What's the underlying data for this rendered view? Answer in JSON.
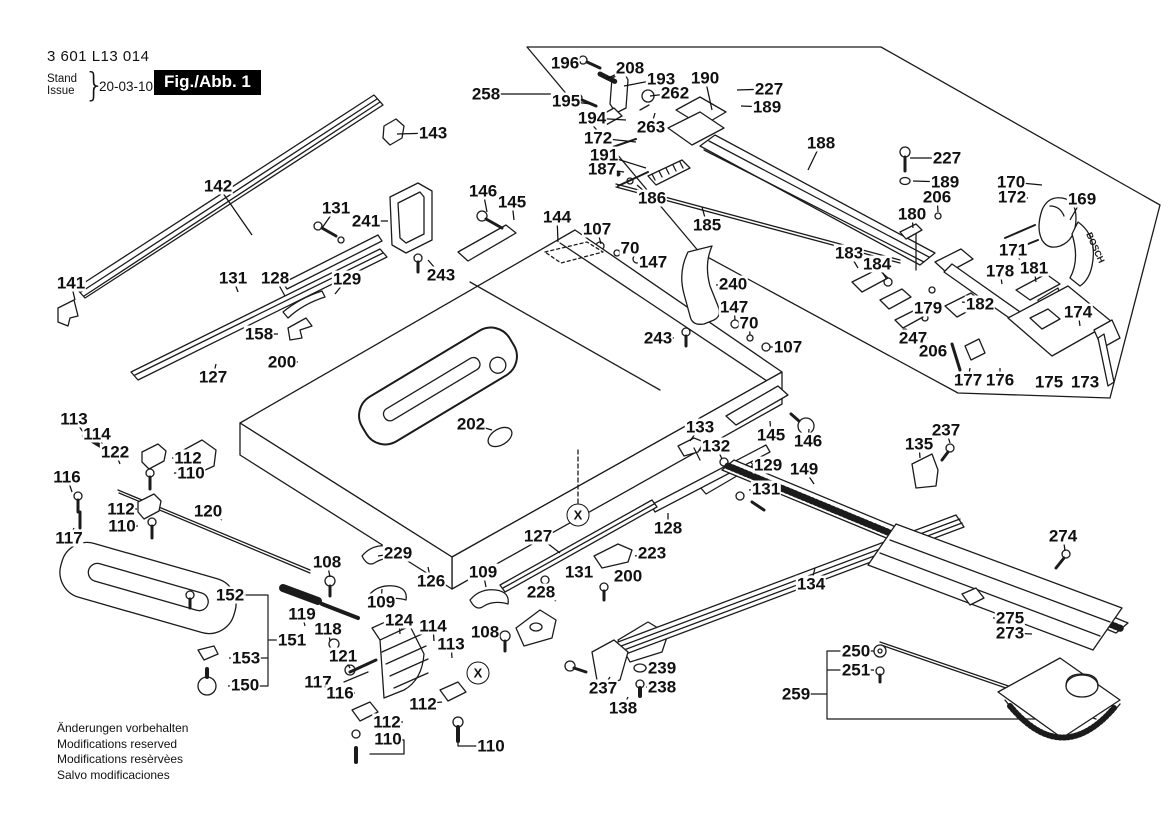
{
  "header": {
    "part_number": "3 601 L13 014",
    "stand_label": "Stand",
    "issue_label": "Issue",
    "brace": "}",
    "date": "20-03-10",
    "figure_label": "Fig./Abb. 1"
  },
  "footer": {
    "line1": "Änderungen vorbehalten",
    "line2": "Modifications reserved",
    "line3": "Modifications resèrvèes",
    "line4": "Salvo modificaciones"
  },
  "badge_text": "BOSCH",
  "symbols": [
    {
      "t": "X",
      "x": 578,
      "y": 515
    },
    {
      "t": "X",
      "x": 478,
      "y": 673
    }
  ],
  "labels": [
    {
      "t": "143",
      "x": 433,
      "y": 133,
      "l": [
        397,
        134
      ]
    },
    {
      "t": "142",
      "x": 218,
      "y": 186,
      "l": [
        252,
        235
      ]
    },
    {
      "t": "131",
      "x": 336,
      "y": 208,
      "l": [
        322,
        228
      ]
    },
    {
      "t": "241",
      "x": 366,
      "y": 221,
      "l": [
        388,
        221
      ]
    },
    {
      "t": "146",
      "x": 483,
      "y": 191,
      "l": [
        487,
        212
      ]
    },
    {
      "t": "145",
      "x": 512,
      "y": 202,
      "l": [
        514,
        220
      ]
    },
    {
      "t": "144",
      "x": 557,
      "y": 217,
      "l": [
        558,
        242
      ]
    },
    {
      "t": "107",
      "x": 597,
      "y": 229,
      "l": [
        601,
        244
      ]
    },
    {
      "t": "70",
      "x": 630,
      "y": 248,
      "l": [
        620,
        252
      ]
    },
    {
      "t": "147",
      "x": 653,
      "y": 262,
      "l": [
        641,
        261
      ]
    },
    {
      "t": "186",
      "x": 652,
      "y": 198,
      "l": [
        637,
        185
      ]
    },
    {
      "t": "243",
      "x": 441,
      "y": 275,
      "l": [
        428,
        260
      ]
    },
    {
      "t": "258",
      "x": 486,
      "y": 94,
      "l": [
        560,
        94
      ]
    },
    {
      "t": "196",
      "x": 565,
      "y": 63,
      "l": [
        581,
        62
      ]
    },
    {
      "t": "208",
      "x": 630,
      "y": 68,
      "l": [
        606,
        79
      ]
    },
    {
      "t": "193",
      "x": 661,
      "y": 79,
      "l": [
        624,
        86
      ]
    },
    {
      "t": "190",
      "x": 705,
      "y": 78,
      "l": [
        712,
        110
      ]
    },
    {
      "t": "227",
      "x": 769,
      "y": 89,
      "l": [
        737,
        90
      ]
    },
    {
      "t": "262",
      "x": 675,
      "y": 93,
      "l": [
        650,
        96
      ]
    },
    {
      "t": "189",
      "x": 767,
      "y": 107,
      "l": [
        741,
        106
      ]
    },
    {
      "t": "195",
      "x": 566,
      "y": 101,
      "l": [
        591,
        104
      ]
    },
    {
      "t": "194",
      "x": 592,
      "y": 118,
      "l": [
        626,
        120
      ]
    },
    {
      "t": "263",
      "x": 651,
      "y": 127,
      "l": [
        655,
        113
      ]
    },
    {
      "t": "172",
      "x": 598,
      "y": 138,
      "l": [
        636,
        142
      ]
    },
    {
      "t": "191",
      "x": 604,
      "y": 155,
      "l": [
        646,
        168
      ]
    },
    {
      "t": "187",
      "x": 602,
      "y": 169,
      "l": [
        624,
        172
      ]
    },
    {
      "t": "185",
      "x": 707,
      "y": 225,
      "l": [
        702,
        207
      ]
    },
    {
      "t": "188",
      "x": 821,
      "y": 143,
      "l": [
        808,
        170
      ]
    },
    {
      "t": "227",
      "x": 947,
      "y": 158,
      "l": [
        910,
        158
      ]
    },
    {
      "t": "189",
      "x": 945,
      "y": 182,
      "l": [
        913,
        181
      ]
    },
    {
      "t": "206",
      "x": 937,
      "y": 197,
      "l": [
        938,
        212
      ]
    },
    {
      "t": "180",
      "x": 912,
      "y": 214,
      "l": [
        913,
        228
      ]
    },
    {
      "t": "170",
      "x": 1011,
      "y": 182,
      "l": [
        1042,
        185
      ]
    },
    {
      "t": "172",
      "x": 1012,
      "y": 197,
      "l": [
        1028,
        198
      ]
    },
    {
      "t": "169",
      "x": 1082,
      "y": 199,
      "l": [
        1070,
        220
      ]
    },
    {
      "t": "171",
      "x": 1013,
      "y": 250,
      "l": [
        1020,
        260
      ]
    },
    {
      "t": "183",
      "x": 849,
      "y": 253,
      "l": [
        858,
        268
      ]
    },
    {
      "t": "184",
      "x": 877,
      "y": 264,
      "l": [
        886,
        278
      ]
    },
    {
      "t": "178",
      "x": 1000,
      "y": 271,
      "l": [
        1002,
        284
      ]
    },
    {
      "t": "181",
      "x": 1034,
      "y": 268,
      "l": [
        1036,
        282
      ]
    },
    {
      "t": "179",
      "x": 928,
      "y": 308,
      "l": [
        940,
        316
      ]
    },
    {
      "t": "182",
      "x": 980,
      "y": 304,
      "l": [
        962,
        302
      ]
    },
    {
      "t": "174",
      "x": 1078,
      "y": 312,
      "l": [
        1080,
        326
      ]
    },
    {
      "t": "247",
      "x": 913,
      "y": 338,
      "l": [
        928,
        338
      ]
    },
    {
      "t": "206",
      "x": 933,
      "y": 351,
      "l": [
        946,
        351
      ]
    },
    {
      "t": "177",
      "x": 968,
      "y": 380,
      "l": [
        970,
        368
      ]
    },
    {
      "t": "176",
      "x": 1000,
      "y": 380,
      "l": [
        1000,
        368
      ]
    },
    {
      "t": "175",
      "x": 1049,
      "y": 382,
      "l": [
        1062,
        380
      ]
    },
    {
      "t": "173",
      "x": 1085,
      "y": 382,
      "l": [
        1098,
        380
      ]
    },
    {
      "t": "141",
      "x": 71,
      "y": 283,
      "l": [
        75,
        300
      ]
    },
    {
      "t": "131",
      "x": 233,
      "y": 278,
      "l": [
        238,
        292
      ]
    },
    {
      "t": "128",
      "x": 275,
      "y": 278,
      "l": [
        285,
        296
      ]
    },
    {
      "t": "129",
      "x": 347,
      "y": 279,
      "l": [
        335,
        294
      ]
    },
    {
      "t": "158",
      "x": 259,
      "y": 334,
      "l": [
        278,
        334
      ]
    },
    {
      "t": "200",
      "x": 282,
      "y": 362,
      "l": [
        298,
        362
      ]
    },
    {
      "t": "127",
      "x": 213,
      "y": 377,
      "l": [
        216,
        364
      ]
    },
    {
      "t": "113",
      "x": 74,
      "y": 419,
      "l": [
        90,
        442
      ]
    },
    {
      "t": "114",
      "x": 97,
      "y": 434,
      "l": [
        104,
        447
      ]
    },
    {
      "t": "122",
      "x": 115,
      "y": 452,
      "l": [
        120,
        464
      ]
    },
    {
      "t": "112",
      "x": 188,
      "y": 458,
      "l": [
        172,
        458
      ]
    },
    {
      "t": "110",
      "x": 191,
      "y": 473,
      "l": [
        174,
        473
      ]
    },
    {
      "t": "116",
      "x": 67,
      "y": 477,
      "l": [
        72,
        492
      ]
    },
    {
      "t": "112",
      "x": 121,
      "y": 509,
      "l": [
        137,
        509
      ]
    },
    {
      "t": "110",
      "x": 122,
      "y": 526,
      "l": [
        138,
        526
      ]
    },
    {
      "t": "117",
      "x": 69,
      "y": 538,
      "l": [
        74,
        528
      ]
    },
    {
      "t": "120",
      "x": 208,
      "y": 511,
      "l": [
        222,
        520
      ]
    },
    {
      "t": "202",
      "x": 471,
      "y": 424,
      "l": [
        492,
        430
      ]
    },
    {
      "t": "133",
      "x": 700,
      "y": 427,
      "l": [
        690,
        441
      ]
    },
    {
      "t": "132",
      "x": 716,
      "y": 446,
      "l": [
        722,
        459
      ]
    },
    {
      "t": "145",
      "x": 771,
      "y": 435,
      "l": [
        770,
        421
      ]
    },
    {
      "t": "146",
      "x": 808,
      "y": 441,
      "l": [
        809,
        429
      ]
    },
    {
      "t": "129",
      "x": 768,
      "y": 465,
      "l": [
        751,
        466
      ]
    },
    {
      "t": "149",
      "x": 804,
      "y": 469,
      "l": [
        814,
        484
      ]
    },
    {
      "t": "131",
      "x": 766,
      "y": 489,
      "l": [
        749,
        490
      ]
    },
    {
      "t": "128",
      "x": 668,
      "y": 528,
      "l": [
        668,
        513
      ]
    },
    {
      "t": "127",
      "x": 538,
      "y": 536,
      "l": [
        560,
        553
      ]
    },
    {
      "t": "108",
      "x": 327,
      "y": 562,
      "l": [
        330,
        577
      ]
    },
    {
      "t": "229",
      "x": 398,
      "y": 553,
      "l": [
        378,
        556
      ]
    },
    {
      "t": "126",
      "x": 431,
      "y": 581,
      "l": [
        428,
        567
      ]
    },
    {
      "t": "109",
      "x": 381,
      "y": 602,
      "l": [
        382,
        589
      ]
    },
    {
      "t": "109",
      "x": 483,
      "y": 572,
      "l": [
        486,
        587
      ]
    },
    {
      "t": "223",
      "x": 652,
      "y": 553,
      "l": [
        635,
        556
      ]
    },
    {
      "t": "131",
      "x": 579,
      "y": 572,
      "l": [
        564,
        574
      ]
    },
    {
      "t": "200",
      "x": 628,
      "y": 576,
      "l": [
        614,
        578
      ]
    },
    {
      "t": "228",
      "x": 541,
      "y": 592,
      "l": [
        556,
        601
      ]
    },
    {
      "t": "108",
      "x": 485,
      "y": 632,
      "l": [
        500,
        634
      ]
    },
    {
      "t": "152",
      "x": 230,
      "y": 595,
      "l": [
        245,
        595
      ]
    },
    {
      "t": "151",
      "x": 292,
      "y": 640,
      "l": [
        277,
        640
      ]
    },
    {
      "t": "153",
      "x": 246,
      "y": 658,
      "l": [
        229,
        658
      ]
    },
    {
      "t": "150",
      "x": 245,
      "y": 685,
      "l": [
        228,
        686
      ]
    },
    {
      "t": "119",
      "x": 302,
      "y": 614,
      "l": [
        305,
        626
      ]
    },
    {
      "t": "118",
      "x": 328,
      "y": 629,
      "l": [
        330,
        641
      ]
    },
    {
      "t": "121",
      "x": 343,
      "y": 656,
      "l": [
        350,
        668
      ]
    },
    {
      "t": "117",
      "x": 318,
      "y": 682,
      "l": [
        332,
        683
      ]
    },
    {
      "t": "116",
      "x": 340,
      "y": 693,
      "l": [
        355,
        693
      ]
    },
    {
      "t": "124",
      "x": 399,
      "y": 620,
      "l": [
        400,
        634
      ]
    },
    {
      "t": "114",
      "x": 433,
      "y": 626,
      "l": [
        434,
        641
      ]
    },
    {
      "t": "113",
      "x": 451,
      "y": 644,
      "l": [
        452,
        658
      ]
    },
    {
      "t": "112",
      "x": 423,
      "y": 704,
      "l": [
        442,
        702
      ]
    },
    {
      "t": "112",
      "x": 387,
      "y": 722,
      "l": [
        403,
        722
      ]
    },
    {
      "t": "110",
      "x": 388,
      "y": 739,
      "l": [
        404,
        740
      ]
    },
    {
      "t": "110",
      "x": 491,
      "y": 746,
      "l": [
        474,
        746
      ]
    },
    {
      "t": "237",
      "x": 603,
      "y": 688,
      "l": [
        610,
        677
      ]
    },
    {
      "t": "239",
      "x": 662,
      "y": 668,
      "l": [
        646,
        668
      ]
    },
    {
      "t": "238",
      "x": 662,
      "y": 687,
      "l": [
        646,
        687
      ]
    },
    {
      "t": "138",
      "x": 623,
      "y": 708,
      "l": [
        628,
        697
      ]
    },
    {
      "t": "134",
      "x": 811,
      "y": 584,
      "l": [
        815,
        568
      ]
    },
    {
      "t": "274",
      "x": 1063,
      "y": 536,
      "l": [
        1065,
        551
      ]
    },
    {
      "t": "275",
      "x": 1010,
      "y": 618,
      "l": [
        993,
        618
      ]
    },
    {
      "t": "273",
      "x": 1010,
      "y": 633,
      "l": [
        1032,
        634
      ]
    },
    {
      "t": "250",
      "x": 856,
      "y": 651,
      "l": [
        874,
        651
      ]
    },
    {
      "t": "251",
      "x": 856,
      "y": 670,
      "l": [
        874,
        670
      ]
    },
    {
      "t": "259",
      "x": 796,
      "y": 694,
      "l": [
        812,
        694
      ]
    },
    {
      "t": "237",
      "x": 946,
      "y": 430,
      "l": [
        950,
        443
      ]
    },
    {
      "t": "135",
      "x": 919,
      "y": 444,
      "l": [
        920,
        458
      ]
    },
    {
      "t": "240",
      "x": 733,
      "y": 284,
      "l": [
        716,
        285
      ]
    },
    {
      "t": "147",
      "x": 734,
      "y": 307,
      "l": [
        735,
        320
      ]
    },
    {
      "t": "70",
      "x": 749,
      "y": 323,
      "l": [
        750,
        335
      ]
    },
    {
      "t": "243",
      "x": 658,
      "y": 338,
      "l": [
        674,
        338
      ]
    },
    {
      "t": "107",
      "x": 788,
      "y": 347,
      "l": [
        770,
        347
      ]
    }
  ]
}
